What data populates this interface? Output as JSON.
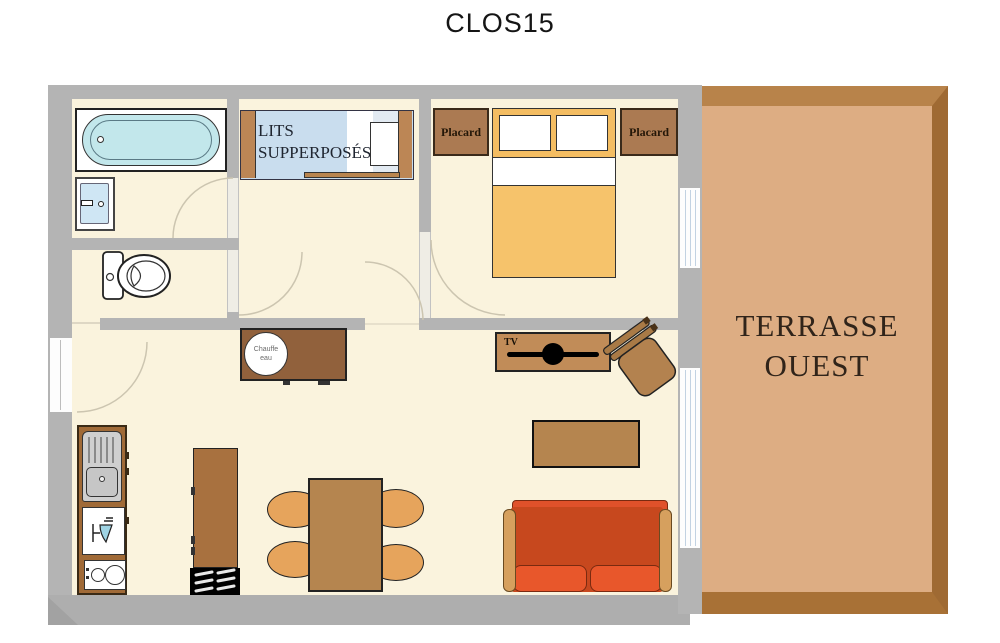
{
  "title": "CLOS15",
  "plan": {
    "bunk_room": {
      "label_line1": "LITS",
      "label_line2": "SUPPERPOSÉS"
    },
    "bedroom": {
      "placard_left_label": "Placard",
      "placard_right_label": "Placard"
    },
    "living_room": {
      "tv_label": "TV",
      "water_heater_line1": "Chauffe",
      "water_heater_line2": "eau"
    },
    "terrace": {
      "label_line1": "TERRASSE",
      "label_line2": "OUEST"
    }
  },
  "colors": {
    "wall": "#b4b4b4",
    "floor": "#faf3dd",
    "terrace_fill": "#ddad83",
    "terrace_frame": "#a87136",
    "tub_blue": "#c2e7eb",
    "mattress_blue": "#c9ddee",
    "bed_orange": "#f6c36b",
    "wood_dark": "#91613c",
    "wood_mid": "#b5854f",
    "chair_light": "#e6a45c",
    "sofa_body": "#c7481e",
    "sofa_cushion": "#e8572b",
    "armrest_tan": "#d6a05e"
  }
}
